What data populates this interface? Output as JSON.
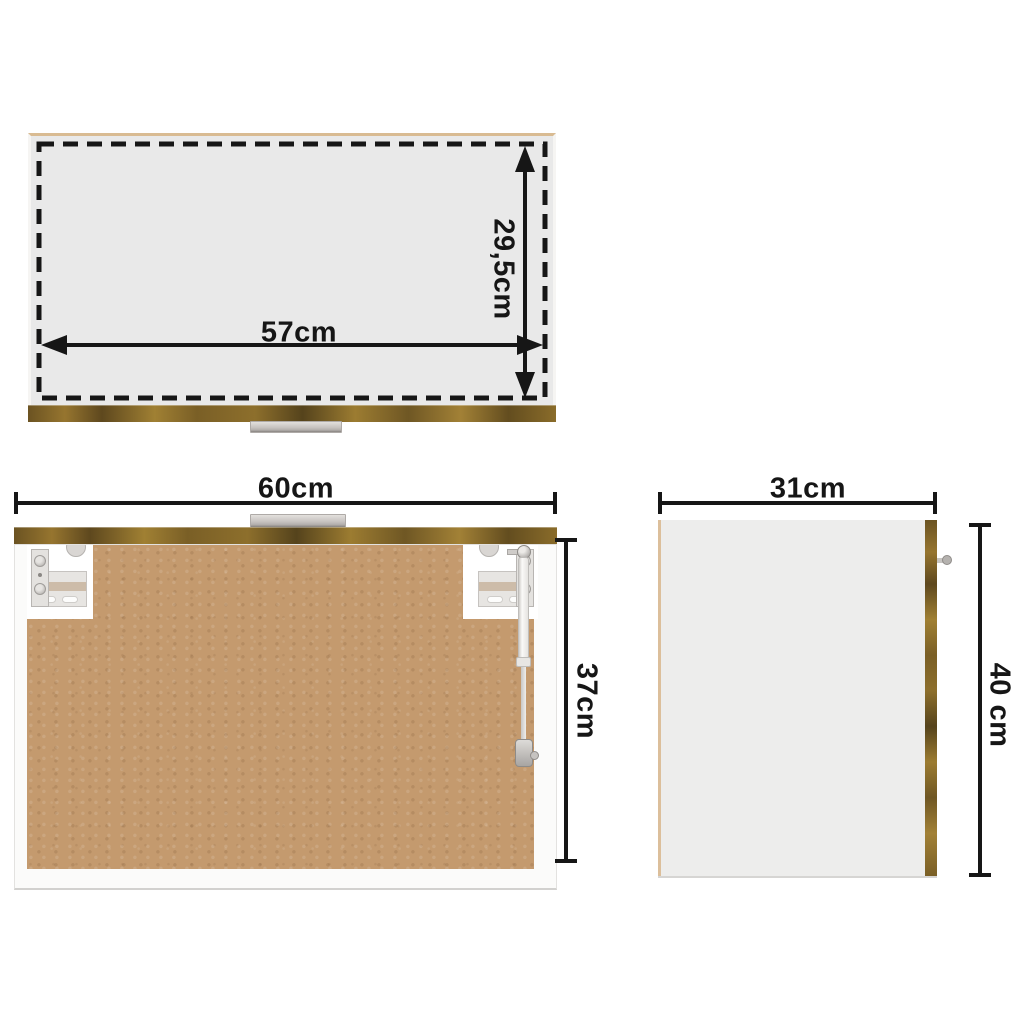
{
  "views": {
    "top": {
      "width_label": "57cm",
      "depth_label": "29,5cm"
    },
    "front": {
      "width_label": "60cm",
      "height_label": "37cm"
    },
    "side": {
      "width_label": "31cm",
      "height_label": "40 cm"
    }
  },
  "colors": {
    "background": "#ffffff",
    "dimension_ink": "#161616",
    "wood_finish_dark": "#55431c",
    "wood_finish_light": "#a28136",
    "mdf_back_panel": "#c49a6e",
    "top_panel_gray": "#e9e9e9",
    "side_panel_gray": "#ededec",
    "hardware_gray": "#cfccc9"
  }
}
